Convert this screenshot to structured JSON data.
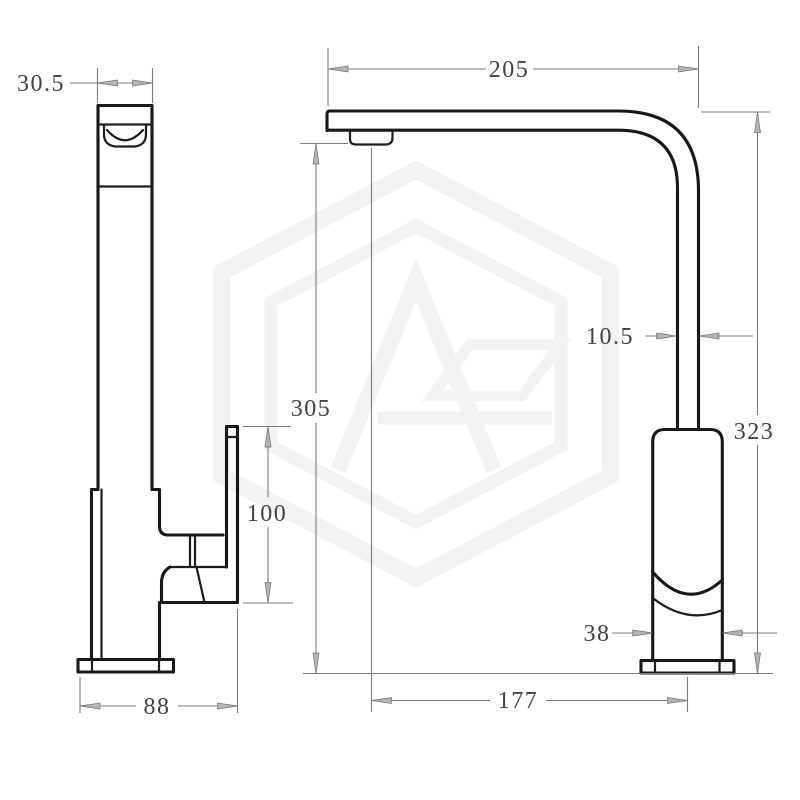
{
  "drawing": {
    "side_view": {
      "spout_head_width": "30.5",
      "handle_height": "100",
      "overall_width": "88"
    },
    "front_view": {
      "spout_reach": "205",
      "spout_clearance_height": "305",
      "spout_tube_width": "10.5",
      "overall_height": "323",
      "body_width": "38",
      "outlet_to_base_distance": "177"
    },
    "colors": {
      "background": "#ffffff",
      "outline": "#181818",
      "dimension_lines": "#7b7b7b",
      "dimension_text": "#414141",
      "watermark": "#f3f3f3"
    }
  }
}
